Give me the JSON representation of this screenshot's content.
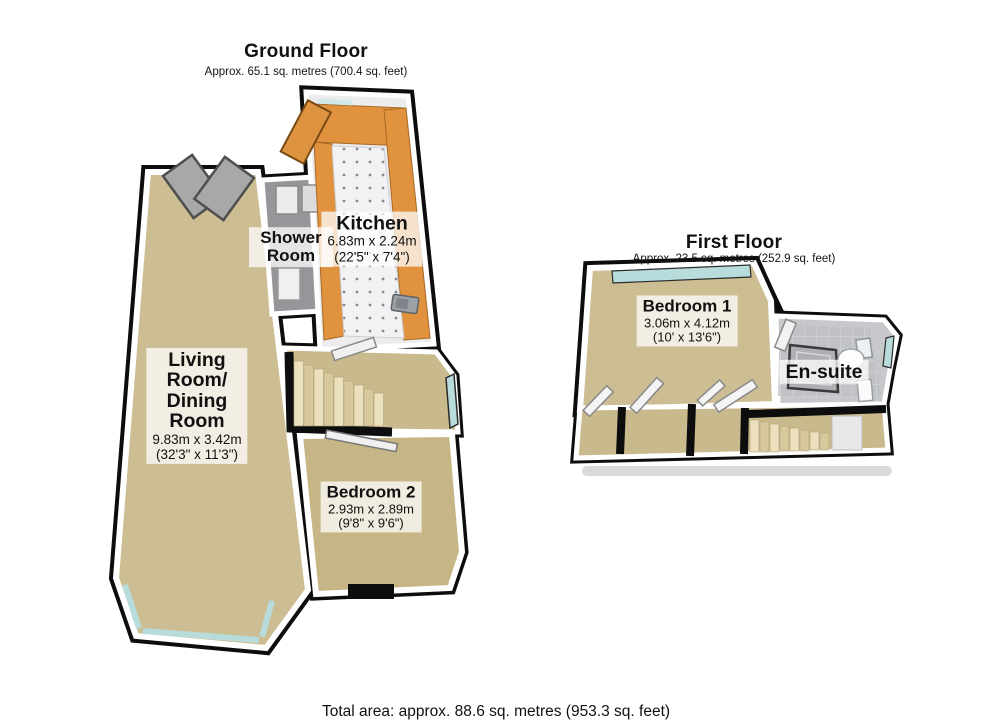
{
  "ground_floor": {
    "title": "Ground Floor",
    "subtitle": "Approx. 65.1 sq. metres (700.4 sq. feet)",
    "rooms": {
      "living_dining": {
        "name": "Living Room/ Dining Room",
        "metric": "9.83m x 3.42m",
        "imperial": "(32'3\" x 11'3\")"
      },
      "kitchen": {
        "name": "Kitchen",
        "metric": "6.83m x 2.24m",
        "imperial": "(22'5\" x 7'4\")"
      },
      "shower_room": {
        "name": "Shower Room"
      },
      "bedroom2": {
        "name": "Bedroom 2",
        "metric": "2.93m x 2.89m",
        "imperial": "(9'8\" x 9'6\")"
      }
    }
  },
  "first_floor": {
    "title": "First Floor",
    "subtitle": "Approx. 23.5 sq. metres (252.9 sq. feet)",
    "rooms": {
      "bedroom1": {
        "name": "Bedroom 1",
        "metric": "3.06m x 4.12m",
        "imperial": "(10' x 13'6\")"
      },
      "ensuite": {
        "name": "En-suite"
      }
    }
  },
  "total_area_label": "Total area: approx. 88.6 sq. metres (953.3 sq. feet)",
  "colors": {
    "wall": "#0d0d0d",
    "wall_rim": "#ffffff",
    "carpet": "#ccbd93",
    "carpet_dark": "#c6b686",
    "kitchen_counter": "#e0923f",
    "kitchen_floor": "#f2f2f4",
    "shower_gray": "#96969a",
    "ensuite_gray": "#c6c8cb",
    "window_glass": "#b7dcdb",
    "stair_light": "#ece1bf",
    "stair_dark": "#d8c89d",
    "shadow": "#dadada"
  }
}
